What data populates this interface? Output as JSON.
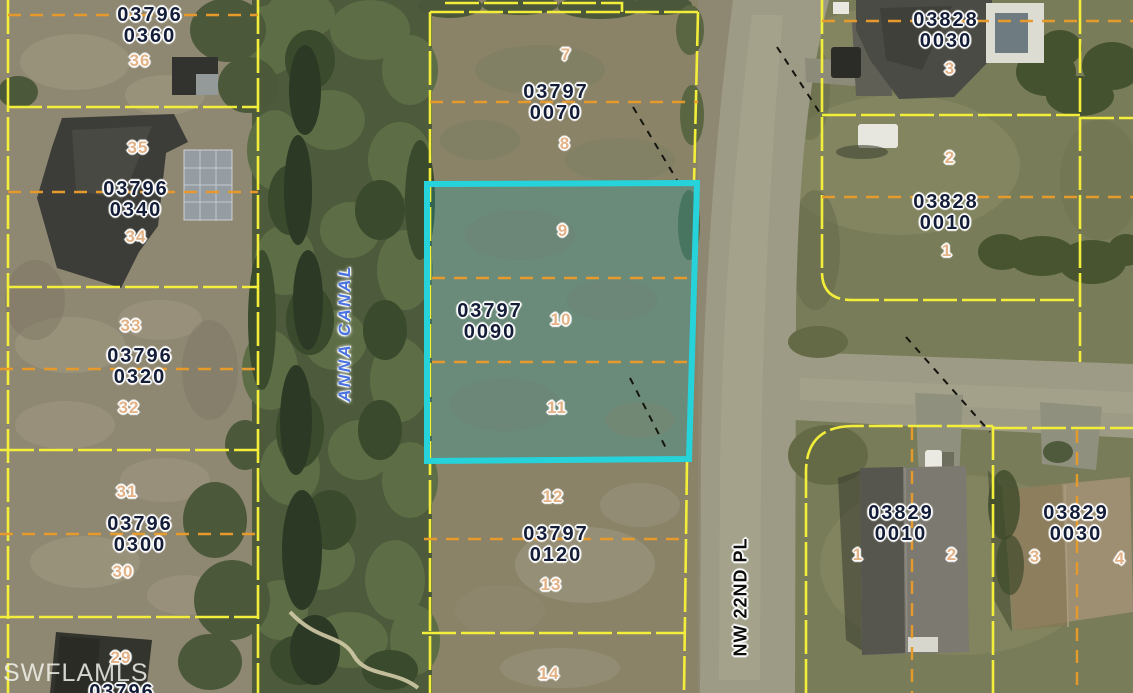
{
  "map": {
    "watermark": "SWFLAMLS",
    "canal_label": "ANNA CANAL",
    "street_label": "NW 22ND PL",
    "cut_label": "03796",
    "parcels": [
      {
        "id": "03796-0360",
        "line1": "03796",
        "line2": "0360"
      },
      {
        "id": "03796-0340",
        "line1": "03796",
        "line2": "0340"
      },
      {
        "id": "03796-0320",
        "line1": "03796",
        "line2": "0320"
      },
      {
        "id": "03796-0300",
        "line1": "03796",
        "line2": "0300"
      },
      {
        "id": "03797-0070",
        "line1": "03797",
        "line2": "0070"
      },
      {
        "id": "03797-0090",
        "line1": "03797",
        "line2": "0090",
        "highlighted": true
      },
      {
        "id": "03797-0120",
        "line1": "03797",
        "line2": "0120"
      },
      {
        "id": "03828-0030",
        "line1": "03828",
        "line2": "0030"
      },
      {
        "id": "03828-0010",
        "line1": "03828",
        "line2": "0010"
      },
      {
        "id": "03829-0010",
        "line1": "03829",
        "line2": "0010"
      },
      {
        "id": "03829-0030",
        "line1": "03829",
        "line2": "0030"
      }
    ],
    "lots": {
      "left": [
        "36",
        "35",
        "34",
        "33",
        "32",
        "31",
        "30",
        "29"
      ],
      "middle": [
        "7",
        "8",
        "9",
        "10",
        "11",
        "12",
        "13",
        "14"
      ],
      "right_top": [
        "3",
        "2",
        "1"
      ],
      "right_bottom": [
        "1",
        "2",
        "3",
        "4"
      ]
    },
    "colors": {
      "boundary_yellow": "#f3ee3a",
      "lot_line_orange": "#e69a2c",
      "highlight_cyan": "#27d3da",
      "highlight_fill": "rgba(32,155,165,0.30)",
      "parcel_text": "#141d38",
      "lot_text": "#e3b287",
      "canal_text": "#4a73e0",
      "street_text": "#0d0d0b",
      "watermark_text": "#f2f2ec"
    }
  }
}
